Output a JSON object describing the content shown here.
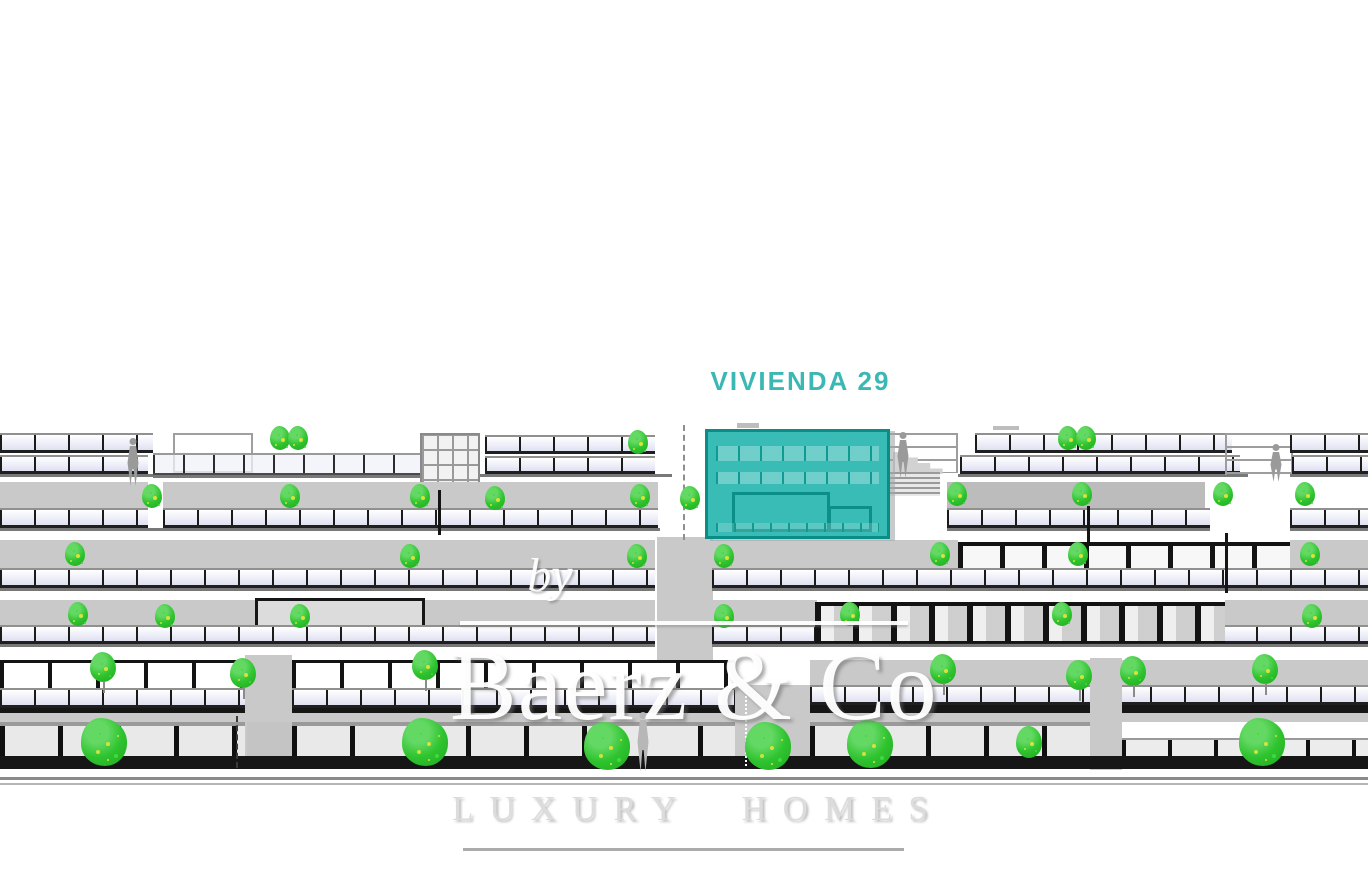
{
  "unit_label": {
    "text": "VIVIENDA 29",
    "color": "#3cb8b4"
  },
  "watermark": {
    "by_text": "by",
    "brand_text": "Baerz & Co",
    "tagline_text": "LUXURY HOMES"
  },
  "palette": {
    "highlight_teal_fill": "#2eb8b1",
    "highlight_teal_border": "#0b8d87",
    "label_teal": "#3cb8b4",
    "tree_green": "#2fc42f",
    "tree_fleck_yellow": "#cfe23a",
    "wall_gray": "#c9c9c9",
    "glazing_tint": "#dfe1f2",
    "frame_dark": "#161616",
    "watermark_white": "#ffffff",
    "background": "#ffffff"
  }
}
